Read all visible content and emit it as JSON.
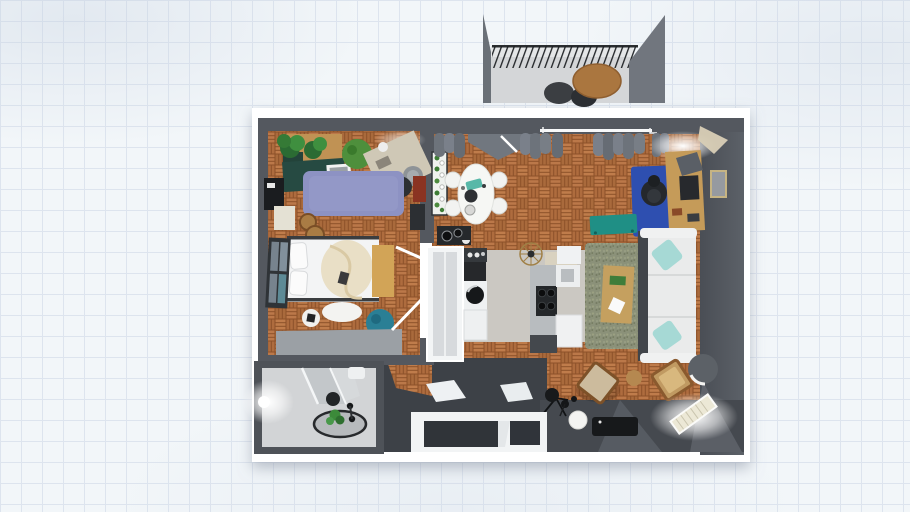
{
  "app": {
    "view": "floor-plan-3d-top-view",
    "canvas_background": "grid-paper",
    "visible_text": []
  },
  "colors": {
    "grid_bg": "#f2f6f9",
    "grid_line": "#dde4ee",
    "card": "#ffffff",
    "wall": "#54585f",
    "wall_light": "#70767e",
    "wall_face": "#4b4f56",
    "entry_floor": "#3d4147",
    "bottom_band": "#45494f",
    "parquet_base": "#b26f41",
    "parquet_gap": "#8c5129",
    "kitchen_floor": "#cbc8c2",
    "bath_floor": "#d2d4d6",
    "purple_rug": "#8d92c3",
    "blue_rug": "#2e4fb0",
    "green_rug": "#8b9179",
    "teal_bench": "#1f8f85",
    "teal_beanbag": "#2a7f95",
    "teal_pillow": "#a6d9d5",
    "sofa": "#eaebeb",
    "bed": "#f3f4f5",
    "duvet": "#e9dfc6",
    "wood_light": "#c59b59",
    "wood_mid": "#a97c44",
    "balcony_table": "#aa763f",
    "balcony_wall": "#6a7077",
    "plant_green": "#3f8f3f",
    "plant_dark": "#2b6b33",
    "dark_item": "#232629",
    "radiator": "#ece8d6",
    "glow": "#ffffff"
  },
  "scene": {
    "rooms": [
      {
        "name": "balcony",
        "furniture": [
          "railing",
          "outdoor-table",
          "outdoor-chair-left",
          "outdoor-chair-right"
        ]
      },
      {
        "name": "bedroom-office",
        "furniture": [
          "potted-palms",
          "dresser",
          "green-desk",
          "laptop",
          "shrub-plant",
          "drafting-table",
          "round-stool",
          "office-chair",
          "shag-rug",
          "tv-stand",
          "cream-cabinet",
          "red-cushion",
          "side-unit",
          "wood-poufs",
          "double-bed",
          "pillows",
          "duvet",
          "bedside-bench",
          "window",
          "round-white-rug",
          "tray",
          "bean-bag",
          "floor-mat",
          "door-leaves"
        ]
      },
      {
        "name": "bathroom",
        "furniture": [
          "wall-light",
          "shower-glass",
          "round-rug",
          "plant",
          "black-stool",
          "vanity-chair"
        ]
      },
      {
        "name": "kitchen",
        "furniture": [
          "cooktop-with-pots",
          "fridge",
          "coffee-station",
          "black-cabinet",
          "washing-machine",
          "base-cabinet",
          "counter",
          "stove",
          "sink",
          "dishwasher",
          "ceiling-light",
          "upper-shelf"
        ]
      },
      {
        "name": "dining",
        "furniture": [
          "plant-shelf",
          "oval-table",
          "dining-chair-1",
          "dining-chair-2",
          "dining-chair-3",
          "dining-chair-4"
        ]
      },
      {
        "name": "living-room",
        "furniture": [
          "curtains",
          "window-strip",
          "entry-door",
          "blue-rug",
          "desk",
          "monitor",
          "desk-lamp",
          "corner-shelf",
          "wall-picture",
          "office-chair",
          "teal-bench",
          "sofa",
          "teal-pillow-top",
          "teal-pillow-bottom",
          "green-rug",
          "coffee-table",
          "armchair-left",
          "armchair-right",
          "tripod-lamp",
          "white-sphere-lamp",
          "gray-sphere-lamp",
          "radiator",
          "tv-console",
          "bottom-windows",
          "entry-hall-doors"
        ]
      }
    ]
  }
}
